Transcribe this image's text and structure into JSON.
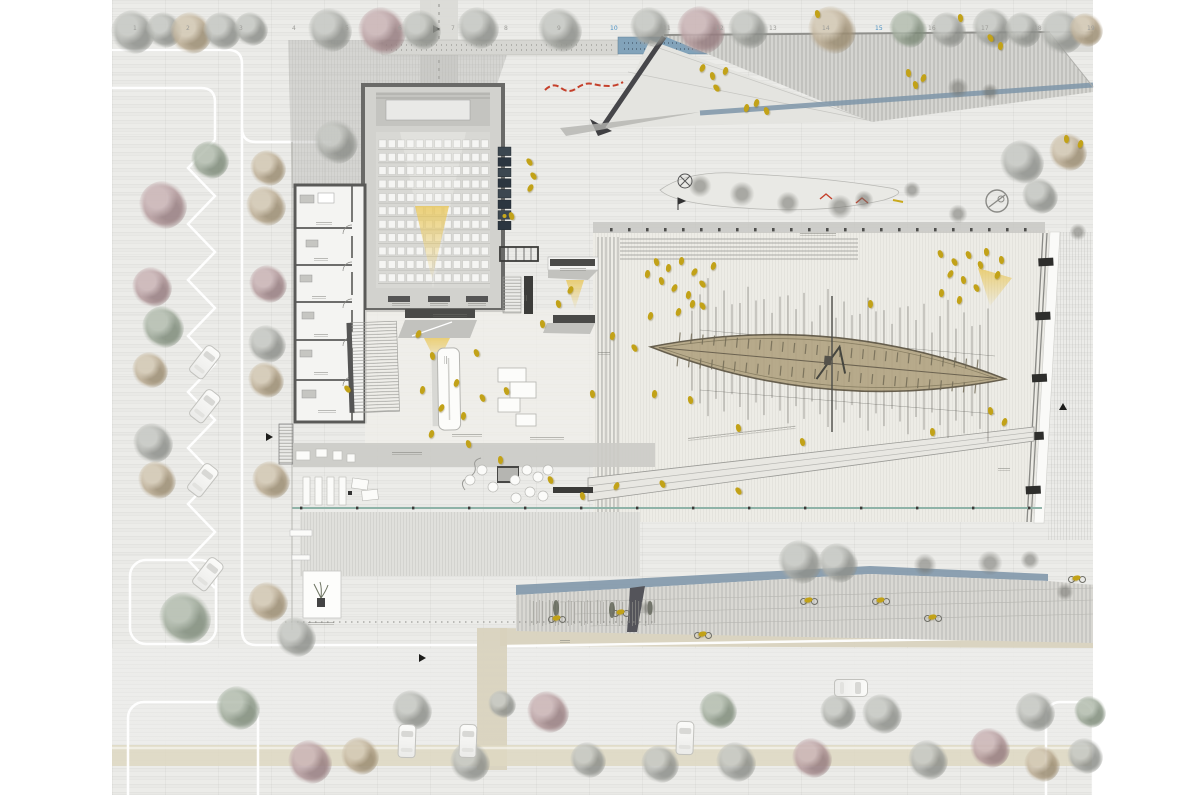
{
  "drawing": {
    "type": "architectural-site-plan",
    "depicts": "museum site plan with auditorium, entrance lobby, exhibition hall containing an ancient boat on supports, plaza roofscapes, parking, roads and trees"
  },
  "colors": {
    "people": "#c2a218",
    "water": "#82a3ba",
    "glass_line": "#8fb3a8",
    "roof_shadow": "#7e95a8",
    "cone": "#e9c75a",
    "red_accent": "#c5402b",
    "wall_dark": "#4a4a48",
    "beige_path": "#d8d2bc",
    "boat_hull": "#b3a584"
  },
  "grid": {
    "labels": [
      "1",
      "2",
      "3",
      "4",
      "5",
      "6",
      "7",
      "8",
      "9",
      "10",
      "11",
      "12",
      "13",
      "14",
      "15",
      "16",
      "17",
      "18",
      "19"
    ],
    "start_x": 133,
    "step": 53,
    "y": 26,
    "blue_indices": [
      9,
      14
    ]
  },
  "auditorium": {
    "rows": 11,
    "cols": 12
  },
  "boat": {
    "cx": 828,
    "cy": 363,
    "angle_deg": 5.2,
    "half_len": 178,
    "half_w": 26,
    "mast_x0": 692,
    "mast_x1": 988,
    "mast_step": 8
  },
  "trees": [
    [
      133,
      32,
      22,
      "g"
    ],
    [
      164,
      30,
      18,
      "g"
    ],
    [
      191,
      33,
      21,
      "t"
    ],
    [
      222,
      31,
      19,
      "g"
    ],
    [
      251,
      29,
      17,
      "g"
    ],
    [
      330,
      30,
      22,
      "g"
    ],
    [
      382,
      31,
      24,
      "m"
    ],
    [
      421,
      30,
      20,
      "g"
    ],
    [
      478,
      28,
      21,
      "g"
    ],
    [
      560,
      30,
      22,
      "g"
    ],
    [
      650,
      27,
      20,
      "g"
    ],
    [
      701,
      30,
      24,
      "m"
    ],
    [
      748,
      29,
      20,
      "g"
    ],
    [
      832,
      30,
      24,
      "t"
    ],
    [
      908,
      29,
      19,
      "s"
    ],
    [
      948,
      30,
      18,
      "g"
    ],
    [
      992,
      28,
      20,
      "g"
    ],
    [
      1023,
      30,
      18,
      "g"
    ],
    [
      1062,
      32,
      22,
      "g"
    ],
    [
      1086,
      30,
      17,
      "t"
    ],
    [
      163,
      205,
      24,
      "m"
    ],
    [
      152,
      287,
      20,
      "m"
    ],
    [
      163,
      327,
      21,
      "s"
    ],
    [
      150,
      370,
      18,
      "t"
    ],
    [
      153,
      443,
      20,
      "g"
    ],
    [
      157,
      480,
      19,
      "t"
    ],
    [
      210,
      160,
      19,
      "s"
    ],
    [
      268,
      168,
      18,
      "t"
    ],
    [
      266,
      206,
      20,
      "t"
    ],
    [
      268,
      284,
      19,
      "m"
    ],
    [
      267,
      344,
      19,
      "g"
    ],
    [
      266,
      380,
      18,
      "t"
    ],
    [
      271,
      480,
      19,
      "t"
    ],
    [
      336,
      142,
      22,
      "g"
    ],
    [
      185,
      618,
      26,
      "s"
    ],
    [
      268,
      602,
      20,
      "t"
    ],
    [
      296,
      637,
      20,
      "g"
    ],
    [
      238,
      708,
      22,
      "s"
    ],
    [
      310,
      762,
      22,
      "m"
    ],
    [
      360,
      756,
      19,
      "t"
    ],
    [
      412,
      710,
      20,
      "g"
    ],
    [
      470,
      762,
      20,
      "g"
    ],
    [
      502,
      704,
      14,
      "g"
    ],
    [
      548,
      712,
      21,
      "m"
    ],
    [
      588,
      760,
      18,
      "g"
    ],
    [
      660,
      764,
      19,
      "g"
    ],
    [
      718,
      710,
      19,
      "s"
    ],
    [
      736,
      762,
      20,
      "g"
    ],
    [
      812,
      758,
      20,
      "m"
    ],
    [
      838,
      712,
      18,
      "g"
    ],
    [
      882,
      714,
      20,
      "g"
    ],
    [
      928,
      760,
      20,
      "g"
    ],
    [
      990,
      748,
      20,
      "m"
    ],
    [
      1035,
      712,
      20,
      "g"
    ],
    [
      1042,
      764,
      18,
      "t"
    ],
    [
      1085,
      756,
      18,
      "g"
    ],
    [
      1090,
      712,
      16,
      "s"
    ],
    [
      1022,
      162,
      22,
      "g"
    ],
    [
      1068,
      152,
      19,
      "t"
    ],
    [
      1040,
      196,
      18,
      "g"
    ],
    [
      800,
      562,
      22,
      "g"
    ],
    [
      838,
      563,
      20,
      "g"
    ]
  ],
  "bushes": [
    [
      700,
      186,
      12
    ],
    [
      742,
      194,
      13
    ],
    [
      788,
      203,
      12
    ],
    [
      840,
      207,
      13
    ],
    [
      864,
      200,
      10
    ],
    [
      912,
      190,
      9
    ],
    [
      958,
      214,
      10
    ],
    [
      925,
      565,
      12
    ],
    [
      990,
      563,
      13
    ],
    [
      1030,
      560,
      10
    ],
    [
      1065,
      592,
      9
    ],
    [
      648,
      608,
      8
    ],
    [
      1078,
      232,
      9
    ],
    [
      958,
      88,
      11
    ],
    [
      990,
      92,
      9
    ]
  ],
  "people": [
    [
      654,
      258
    ],
    [
      666,
      264
    ],
    [
      679,
      257
    ],
    [
      692,
      268
    ],
    [
      659,
      277
    ],
    [
      672,
      284
    ],
    [
      686,
      291
    ],
    [
      700,
      280
    ],
    [
      711,
      262
    ],
    [
      645,
      270
    ],
    [
      690,
      300
    ],
    [
      676,
      308
    ],
    [
      938,
      250
    ],
    [
      952,
      258
    ],
    [
      966,
      251
    ],
    [
      978,
      261
    ],
    [
      948,
      270
    ],
    [
      961,
      276
    ],
    [
      984,
      248
    ],
    [
      995,
      271
    ],
    [
      974,
      284
    ],
    [
      939,
      289
    ],
    [
      957,
      296
    ],
    [
      999,
      256
    ],
    [
      648,
      312
    ],
    [
      700,
      302
    ],
    [
      632,
      344
    ],
    [
      652,
      390
    ],
    [
      688,
      396
    ],
    [
      736,
      424
    ],
    [
      800,
      438
    ],
    [
      930,
      428
    ],
    [
      988,
      407
    ],
    [
      1002,
      418
    ],
    [
      868,
      300
    ],
    [
      416,
      330
    ],
    [
      430,
      352
    ],
    [
      474,
      349
    ],
    [
      454,
      379
    ],
    [
      420,
      386
    ],
    [
      439,
      404
    ],
    [
      461,
      412
    ],
    [
      480,
      394
    ],
    [
      504,
      387
    ],
    [
      429,
      430
    ],
    [
      466,
      440
    ],
    [
      498,
      456
    ],
    [
      540,
      320
    ],
    [
      556,
      300
    ],
    [
      568,
      286
    ],
    [
      590,
      390
    ],
    [
      610,
      332
    ],
    [
      345,
      385
    ],
    [
      527,
      158
    ],
    [
      531,
      172
    ],
    [
      528,
      184
    ],
    [
      509,
      212
    ],
    [
      548,
      476
    ],
    [
      580,
      492
    ],
    [
      700,
      64
    ],
    [
      710,
      72
    ],
    [
      723,
      67
    ],
    [
      714,
      84
    ],
    [
      744,
      104
    ],
    [
      754,
      99
    ],
    [
      764,
      107
    ],
    [
      906,
      69
    ],
    [
      913,
      81
    ],
    [
      921,
      74
    ],
    [
      988,
      34
    ],
    [
      998,
      42
    ],
    [
      1064,
      135
    ],
    [
      1078,
      140
    ],
    [
      614,
      482
    ],
    [
      660,
      480
    ],
    [
      736,
      487
    ],
    [
      815,
      10
    ],
    [
      958,
      14
    ]
  ],
  "cyclists": [
    [
      556,
      618
    ],
    [
      620,
      612
    ],
    [
      702,
      634
    ],
    [
      808,
      600
    ],
    [
      880,
      600
    ],
    [
      932,
      617
    ],
    [
      1076,
      578
    ]
  ],
  "cars": {
    "parking_diagonal": [
      [
        196,
        345
      ],
      [
        196,
        389
      ],
      [
        194,
        463
      ],
      [
        199,
        557
      ]
    ],
    "road_vertical": [
      [
        398,
        724
      ],
      [
        459,
        724
      ],
      [
        676,
        721
      ]
    ],
    "road_horizontal": [
      [
        842,
        671
      ]
    ]
  },
  "annotations": [
    [
      433,
      314,
      34,
      0
    ],
    [
      447,
      356,
      8,
      90
    ],
    [
      452,
      434,
      30,
      0
    ],
    [
      530,
      437,
      34,
      0
    ],
    [
      392,
      452,
      30,
      0
    ],
    [
      308,
      622,
      26,
      0
    ],
    [
      688,
      438,
      108,
      -6.5
    ],
    [
      560,
      268,
      26,
      0
    ],
    [
      800,
      233,
      36,
      0
    ],
    [
      392,
      303,
      18,
      0
    ],
    [
      430,
      303,
      18,
      0
    ],
    [
      468,
      303,
      18,
      0
    ],
    [
      316,
      222,
      16,
      0
    ],
    [
      314,
      258,
      14,
      0
    ],
    [
      312,
      296,
      14,
      0
    ],
    [
      314,
      334,
      14,
      0
    ],
    [
      314,
      372,
      14,
      0
    ],
    [
      318,
      410,
      18,
      0
    ],
    [
      527,
      295,
      6,
      90
    ],
    [
      598,
      352,
      12,
      0
    ],
    [
      998,
      468,
      12,
      0
    ],
    [
      560,
      640,
      10,
      0
    ]
  ],
  "markers": [
    [
      433,
      29,
      "r"
    ],
    [
      266,
      437,
      "r"
    ],
    [
      419,
      658,
      "r"
    ],
    [
      1063,
      407,
      "u"
    ]
  ]
}
